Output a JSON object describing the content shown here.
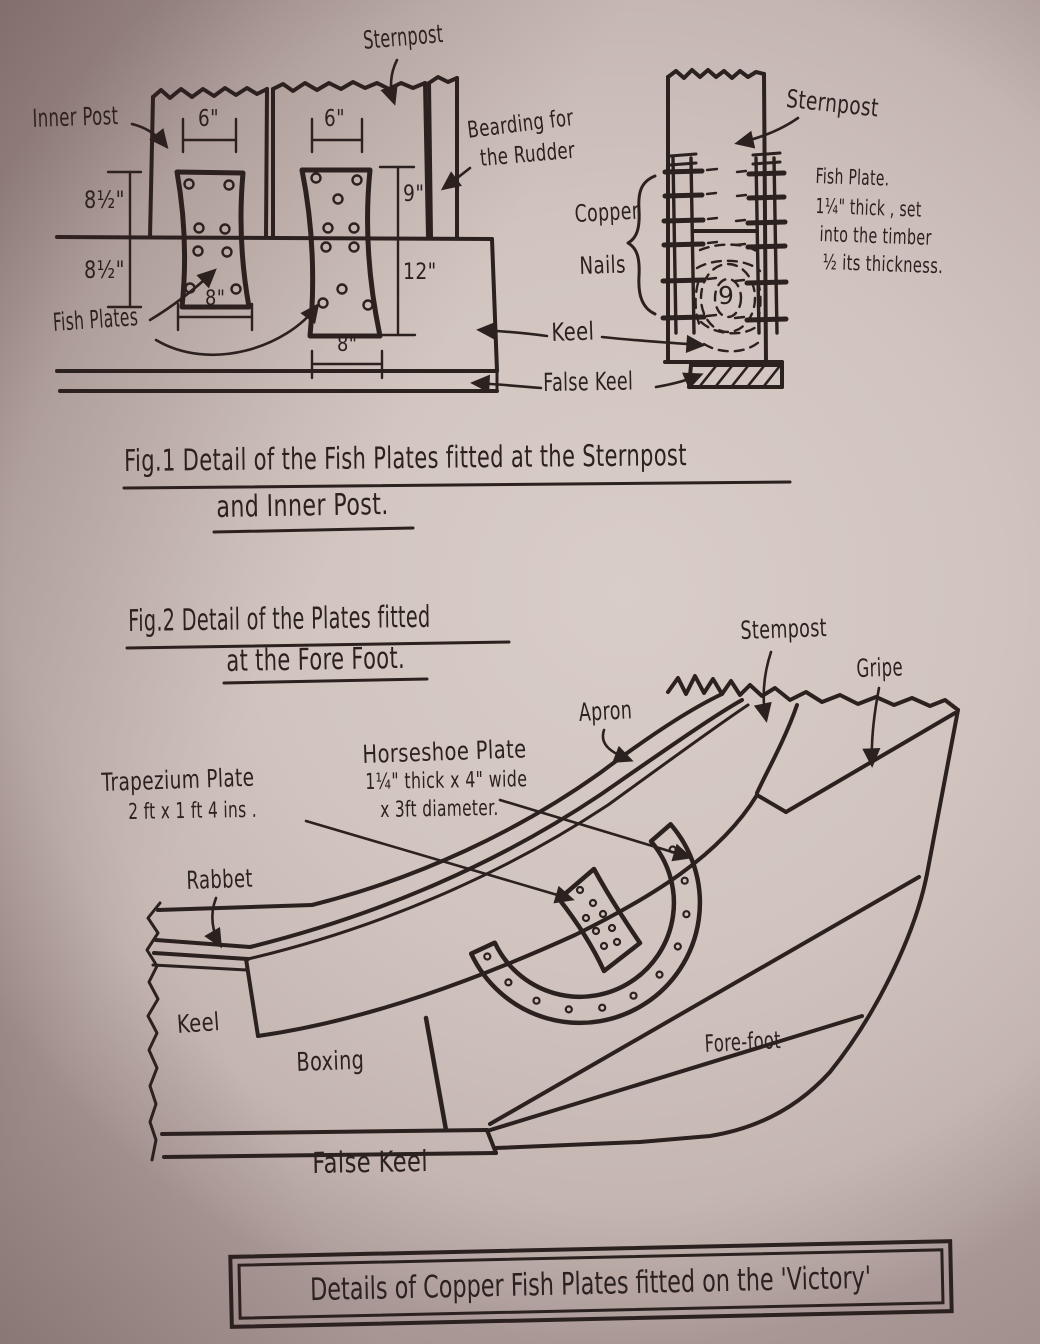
{
  "fig1": {
    "inner_post": "Inner Post",
    "sternpost_top": "Sternpost",
    "bearding_1": "Bearding for",
    "bearding_2": "the Rudder",
    "fish_plates": "Fish Plates",
    "keel": "Keel",
    "false_keel": "False Keel",
    "sternpost_side": "Sternpost",
    "copper": "Copper",
    "nails": "Nails",
    "note_1": "Fish Plate.",
    "note_2": "1¼\" thick , set",
    "note_3": "into the timber",
    "note_4": "½ its thickness.",
    "knot_digit": "9",
    "dims": {
      "plate1_top": "6\"",
      "plate2_top": "6\"",
      "left_upper": "8½\"",
      "left_lower": "8½\"",
      "right_upper": "9\"",
      "right_lower": "12\"",
      "plate1_bottom": "8\"",
      "plate2_bottom": "8\""
    }
  },
  "captions": {
    "fig1_line1": "Fig.1  Detail of the Fish Plates fitted at the Sternpost",
    "fig1_line2": "and Inner Post.",
    "fig2_line1": "Fig.2  Detail of the Plates fitted",
    "fig2_line2": "at the Fore Foot."
  },
  "fig2": {
    "stempost": "Stempost",
    "gripe": "Gripe",
    "apron": "Apron",
    "horseshoe_1": "Horseshoe Plate",
    "horseshoe_2": "1¼\" thick x 4\" wide",
    "horseshoe_3": "x 3ft diameter.",
    "trapezium_1": "Trapezium Plate",
    "trapezium_2": "2 ft  x  1 ft 4 ins .",
    "rabbet": "Rabbet",
    "keel": "Keel",
    "boxing": "Boxing",
    "forefoot": "Fore-foot",
    "false_keel": "False Keel"
  },
  "title": "Details of Copper Fish Plates fitted on the 'Victory'",
  "colors": {
    "paper": "#cfc2bd",
    "ink": "#2b211f"
  }
}
